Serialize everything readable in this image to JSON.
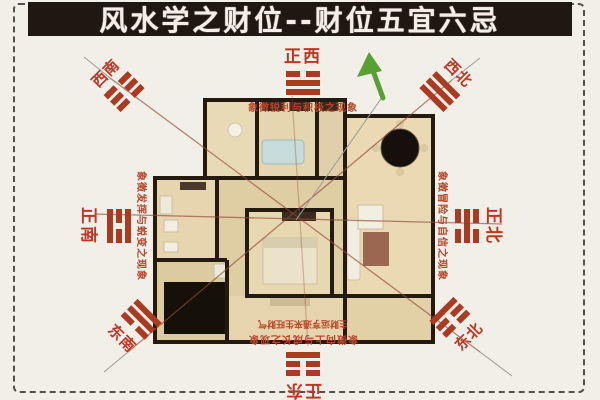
{
  "title": "风水学之财位--财位五宜六忌",
  "colors": {
    "title_bg": "#1e1712",
    "accent_red": "#b5442c",
    "trigram_red": "#ab3a22",
    "frame_dash": "#55504a",
    "plan_beige": "#e4d3ae",
    "wall_dark": "#241a10",
    "arrow_green": "#57a033"
  },
  "icons": {
    "up_arrow_icon": "↑",
    "radiating_lines": "diagonal sight-lines crossing at plan center"
  },
  "compass": {
    "west": {
      "label": "正西",
      "trigram_name": "dui ☱",
      "lines": [
        "broken",
        "solid",
        "solid"
      ],
      "desc": "象徵锐利与积极之现象"
    },
    "southwest": {
      "label": "西南",
      "trigram_name": "kun ☷",
      "lines": [
        "broken",
        "broken",
        "broken"
      ]
    },
    "northwest": {
      "label": "西北",
      "trigram_name": "qian ☰",
      "lines": [
        "solid",
        "solid",
        "solid"
      ]
    },
    "south": {
      "label": "正南",
      "trigram_name": "li ☲",
      "lines": [
        "solid",
        "broken",
        "solid"
      ],
      "desc": "象徵发挥与蜕变之现象"
    },
    "north": {
      "label": "正北",
      "trigram_name": "kan ☵",
      "lines": [
        "broken",
        "solid",
        "broken"
      ],
      "desc": "象徵冒险与自信之现象"
    },
    "southeast": {
      "label": "东南",
      "trigram_name": "xun ☴",
      "lines": [
        "solid",
        "solid",
        "broken"
      ]
    },
    "northeast": {
      "label": "东北",
      "trigram_name": "gen ☶",
      "lines": [
        "solid",
        "broken",
        "broken"
      ]
    },
    "east": {
      "label": "正东",
      "trigram_name": "zhen ☳",
      "lines": [
        "broken",
        "broken",
        "solid"
      ],
      "desc": "象徵向上与成长之现象",
      "desc2": "主财运亨通来生旺财气"
    }
  }
}
